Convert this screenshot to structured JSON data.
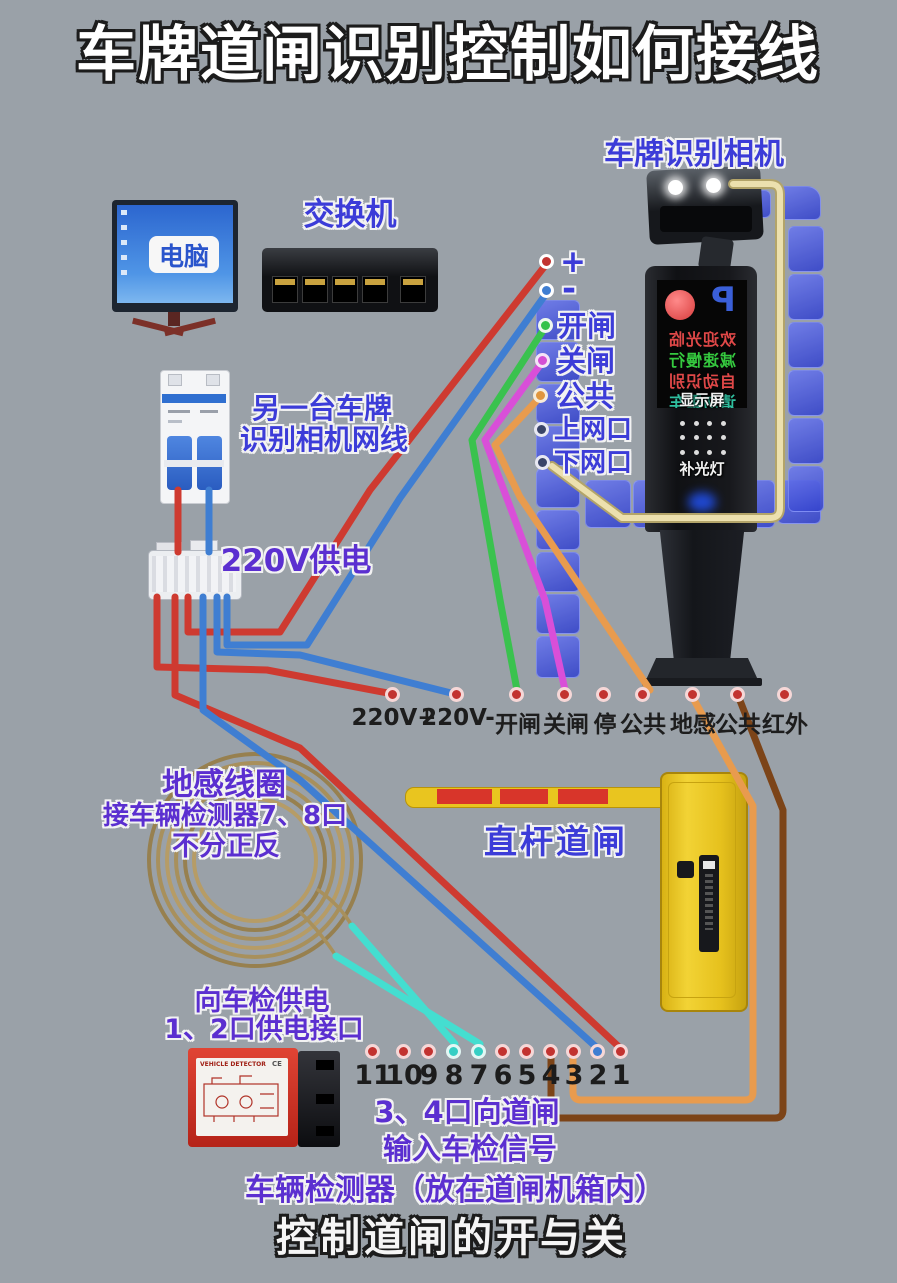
{
  "title": "车牌道闸识别控制如何接线",
  "colors": {
    "bg": "#9aa1a8",
    "red": "#ce3a30",
    "blue": "#3f7ed2",
    "green": "#3ac24e",
    "magenta": "#d94fd8",
    "orange": "#e89b4e",
    "cream": "#ece0ae",
    "cream_edge": "#b3a469",
    "brown": "#7c4418",
    "cyan": "#44ded0",
    "coil_tan": "#a8905c",
    "label_blue": "#3c3cd8",
    "label_purple": "#5b2fd0",
    "block_blue": "#4553dd",
    "gate_yellow": "#e6c11d",
    "detector_red": "#cc2a1e"
  },
  "computer": {
    "label": "电脑"
  },
  "network_switch": {
    "label": "交换机"
  },
  "camera": {
    "label": "车牌识别相机",
    "p_badge": "P",
    "screen_lines": [
      "欢迎光临",
      "减速慢行",
      "自动识别",
      "请勿跟车"
    ],
    "display_tag": "显示屏",
    "light_tag": "补光灯"
  },
  "camera_terminals": {
    "labels": [
      "+",
      "-",
      "开闸",
      "关闸",
      "公共",
      "上网口",
      "下网口"
    ]
  },
  "breaker": {
    "label_line1": "另一台车牌",
    "label_line2": "识别相机网线"
  },
  "power": {
    "label": "220V供电"
  },
  "gate_terminals": {
    "labels": [
      "220V+",
      "220V-",
      "开闸",
      "关闸",
      "停",
      "公共",
      "地感",
      "公共",
      "红外"
    ]
  },
  "coil": {
    "title": "地感线圈",
    "line2": "接车辆检测器7、8口",
    "line3": "不分正反"
  },
  "gate": {
    "label": "直杆道闸"
  },
  "detector": {
    "power_note1": "向车检供电",
    "power_note2": "1、2口供电接口",
    "device_label": "VEHICLE DETECTOR",
    "ce_mark": "CE",
    "ports": [
      "11",
      "10",
      "9",
      "8",
      "7",
      "6",
      "5",
      "4",
      "3",
      "2",
      "1"
    ],
    "signal_note1": "3、4口向道闸",
    "signal_note2": "输入车检信号",
    "caption": "车辆检测器（放在道闸机箱内）"
  },
  "footer": "控制道闸的开与关"
}
